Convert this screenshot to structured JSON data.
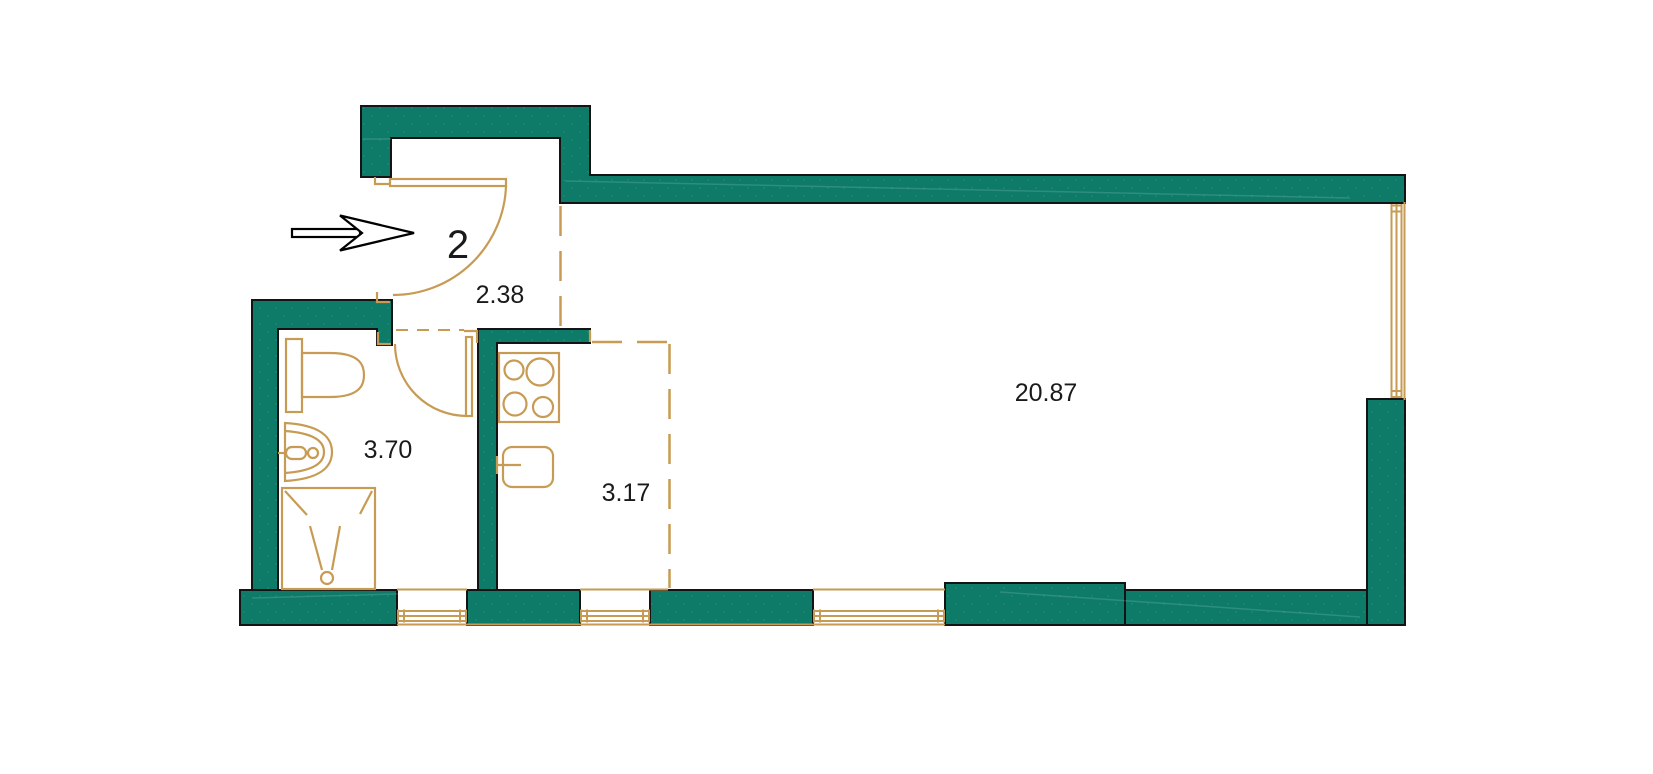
{
  "plan": {
    "title": "apartment floor plan",
    "apartment_number": "2",
    "rooms": [
      {
        "id": "hallway",
        "area_label": "2.38"
      },
      {
        "id": "bathroom",
        "area_label": "3.70"
      },
      {
        "id": "kitchen",
        "area_label": "3.17"
      },
      {
        "id": "living-room",
        "area_label": "20.87"
      }
    ],
    "colors": {
      "wall_fill": "#0d7b68",
      "fixture_stroke": "#c79b53",
      "outline": "#141414",
      "background": "#ffffff",
      "text": "#1a1a1a"
    },
    "icons": [
      "entrance-arrow-icon",
      "entrance-door-swing-icon",
      "bathroom-door-swing-icon",
      "toilet-icon",
      "washbasin-icon",
      "shower-icon",
      "stove-icon",
      "kitchen-sink-icon",
      "window-icon"
    ]
  }
}
